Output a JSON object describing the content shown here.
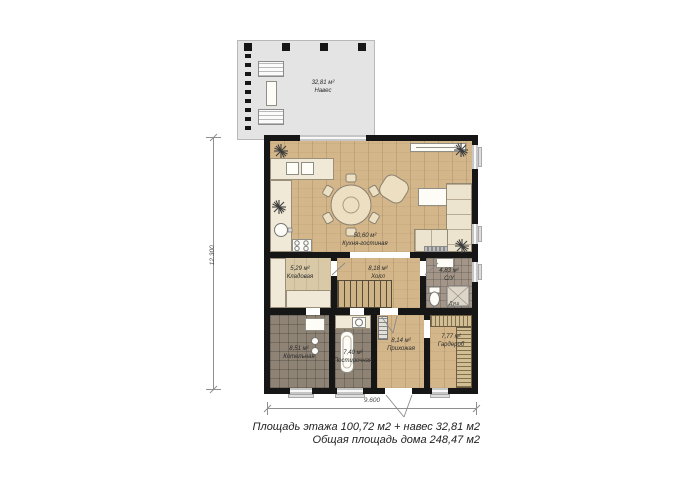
{
  "drawing": {
    "type": "floor-plan",
    "canopy": {
      "area": "32,81 м²",
      "name": "Навес"
    },
    "rooms": [
      {
        "id": "kitchen-living",
        "area": "50,60 м²",
        "name": "Кухня-гостиная"
      },
      {
        "id": "storage",
        "area": "5,29 м²",
        "name": "Кладовая"
      },
      {
        "id": "hall",
        "area": "8,18 м²",
        "name": "Холл"
      },
      {
        "id": "wc",
        "area": "4,83 м²",
        "name": "С/У"
      },
      {
        "id": "boiler-room",
        "area": "8,51 м²",
        "name": "Котельная"
      },
      {
        "id": "laundry",
        "area": "7,40 м²",
        "name": "Постирочная"
      },
      {
        "id": "entry-hall",
        "area": "8,14 м²",
        "name": "Прихожая"
      },
      {
        "id": "wardrobe",
        "area": "7,77 м²",
        "name": "Гардероб"
      }
    ],
    "dimensions": {
      "vertical": "12.300",
      "horizontal": "9.600"
    },
    "summary": {
      "line1": "Площадь этажа 100,72 м2 + навес 32,81 м2",
      "line2": "Общая площадь дома 248,47 м2"
    },
    "wc_labels": {
      "shower": "Душ"
    },
    "legend_symbols": [
      "plant",
      "dining-table",
      "chair",
      "armchair",
      "sofa",
      "tv-stand",
      "coffee-table",
      "kitchen-counter",
      "stove",
      "kitchen-sink",
      "stairs",
      "toilet",
      "shower-tray",
      "wash-basin",
      "washing-machine",
      "laundry-tub",
      "boiler",
      "radiator",
      "wardrobe-shelving",
      "canopy-bench",
      "doormat"
    ],
    "colors": {
      "wall": "#161616",
      "wood_floor": "#d3b68a",
      "tile_dark": "#8e8375",
      "tile_light": "#a39689",
      "canopy": "#e4e4e4",
      "furniture": "#f0e9d8",
      "window": "#c6c6c6",
      "dim_line": "#8f8f8f"
    }
  }
}
